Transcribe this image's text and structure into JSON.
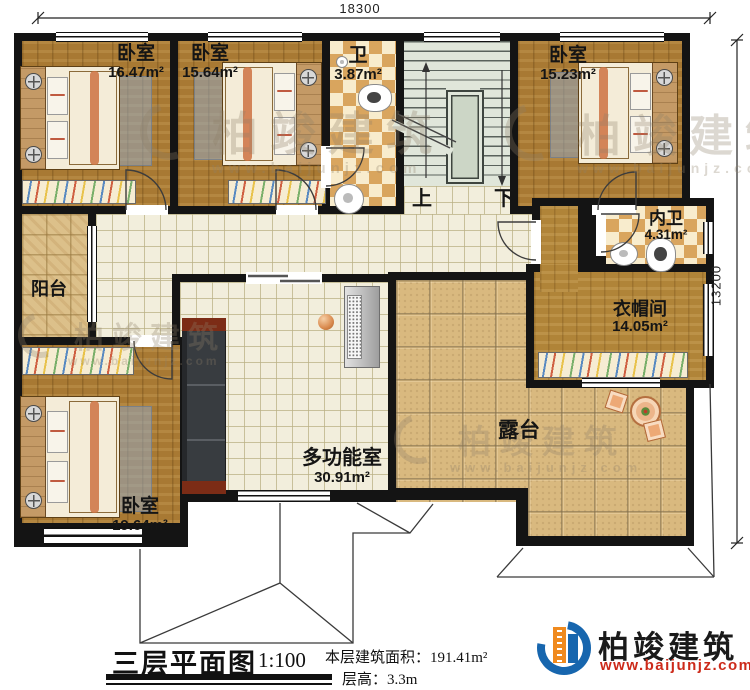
{
  "dims": {
    "top": "18300",
    "right": "13200"
  },
  "rooms": {
    "bedroom_tl": {
      "name": "卧室",
      "area": "16.47m²"
    },
    "bedroom_tm": {
      "name": "卧室",
      "area": "15.64m²"
    },
    "bath": {
      "name": "卫",
      "area": "3.87m²"
    },
    "bedroom_tr": {
      "name": "卧室",
      "area": "15.23m²"
    },
    "inner_bath": {
      "name": "内卫",
      "area": "4.31m²"
    },
    "closet": {
      "name": "衣帽间",
      "area": "14.05m²"
    },
    "balcony": {
      "name": "阳台"
    },
    "bedroom_bl": {
      "name": "卧室",
      "area": "19.64m²"
    },
    "multiroom": {
      "name": "多功能室",
      "area": "30.91m²"
    },
    "terrace": {
      "name": "露台"
    }
  },
  "stairs": {
    "up": "上",
    "down": "下"
  },
  "titleblock": {
    "title": "三层平面图",
    "scale": "1:100",
    "area_label": "本层建筑面积：",
    "area_value": "191.41m²",
    "height_label": "层高：",
    "height_value": "3.3m"
  },
  "logo": {
    "name": "柏竣建筑",
    "url": "www.baijunjz.com"
  },
  "watermark": {
    "text": "柏竣建筑",
    "url": "www.baijunjz.com"
  }
}
